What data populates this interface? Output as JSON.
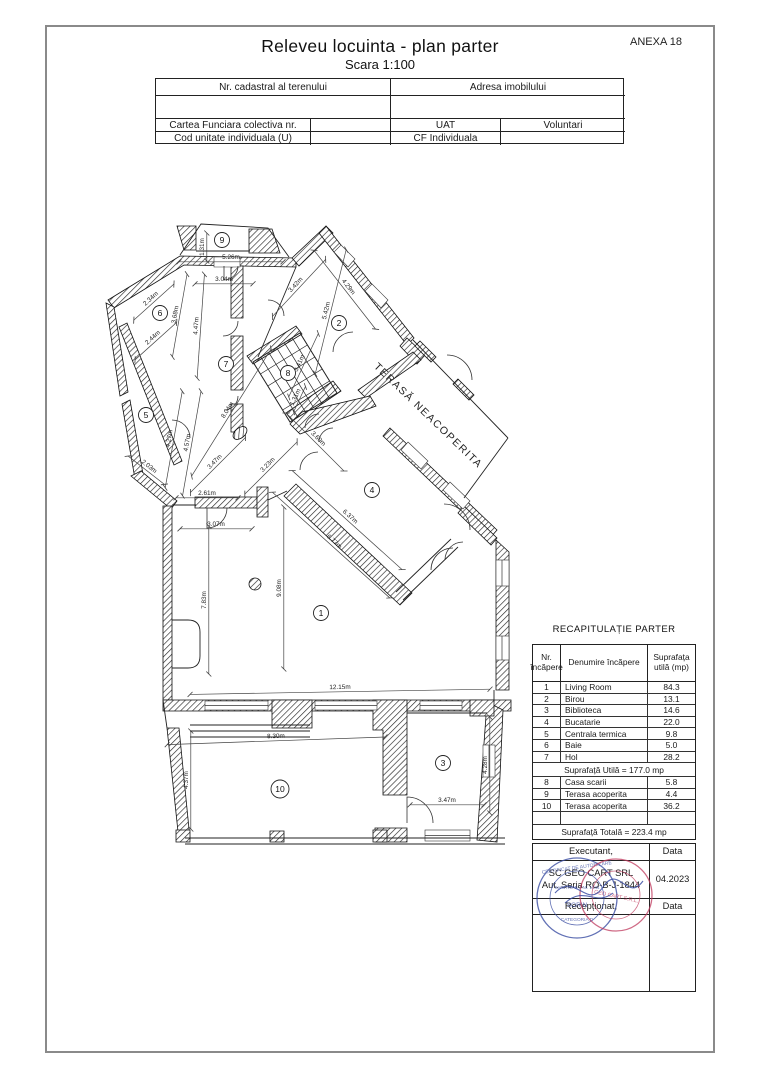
{
  "page": {
    "anexa": "ANEXA 18",
    "title": "Releveu locuinta - plan parter",
    "subtitle": "Scara 1:100"
  },
  "header_table": {
    "nr_cadastral": "Nr. cadastral al terenului",
    "adresa": "Adresa imobilului",
    "cartea": "Cartea Funciara colectiva nr.",
    "cartea_val": "",
    "uat": "UAT",
    "uat_val": "Voluntari",
    "cod": "Cod unitate individuala (U)",
    "cod_val": "",
    "cf": "CF Individuala",
    "cf_val": ""
  },
  "plan": {
    "terasa_label": {
      "t": "TERASĂ NEACOPERITA",
      "x": 426,
      "y": 418,
      "r": 44
    },
    "rooms": [
      {
        "n": "1",
        "x": 321,
        "y": 613
      },
      {
        "n": "2",
        "x": 339,
        "y": 323
      },
      {
        "n": "3",
        "x": 443,
        "y": 763
      },
      {
        "n": "4",
        "x": 372,
        "y": 490
      },
      {
        "n": "5",
        "x": 146,
        "y": 415
      },
      {
        "n": "6",
        "x": 160,
        "y": 313
      },
      {
        "n": "7",
        "x": 226,
        "y": 364
      },
      {
        "n": "8",
        "x": 288,
        "y": 373
      },
      {
        "n": "9",
        "x": 222,
        "y": 240
      },
      {
        "n": "10",
        "x": 280,
        "y": 789
      }
    ],
    "dims": [
      {
        "t": "1.31m",
        "x": 204,
        "y": 247,
        "r": -90,
        "len": 28
      },
      {
        "t": "5.26m",
        "x": 231,
        "y": 259,
        "r": 0,
        "len": 104
      },
      {
        "t": "3.04m",
        "x": 224,
        "y": 281,
        "r": 0,
        "len": 58
      },
      {
        "t": "3.42m",
        "x": 297,
        "y": 286,
        "r": -47,
        "len": 78
      },
      {
        "t": "4.29m",
        "x": 347,
        "y": 288,
        "r": 52,
        "len": 100
      },
      {
        "t": "5.42m",
        "x": 328,
        "y": 311,
        "r": -76,
        "len": 128
      },
      {
        "t": "2.34m",
        "x": 152,
        "y": 300,
        "r": -42,
        "len": 54
      },
      {
        "t": "3.68m",
        "x": 177,
        "y": 315,
        "r": -80,
        "len": 84
      },
      {
        "t": "2.44m",
        "x": 154,
        "y": 339,
        "r": -42,
        "len": 56
      },
      {
        "t": "4.47m",
        "x": 198,
        "y": 326,
        "r": -86,
        "len": 104
      },
      {
        "t": "8.04m",
        "x": 229,
        "y": 411,
        "r": -58,
        "len": 150
      },
      {
        "t": "3.41m",
        "x": 301,
        "y": 364,
        "r": -65,
        "len": 70
      },
      {
        "t": "1.31m",
        "x": 297,
        "y": 398,
        "r": -65,
        "len": 28
      },
      {
        "t": "3.60m",
        "x": 317,
        "y": 440,
        "r": 45,
        "len": 82
      },
      {
        "t": "3.23m",
        "x": 269,
        "y": 466,
        "r": -45,
        "len": 74
      },
      {
        "t": "4.27m",
        "x": 171,
        "y": 439,
        "r": -80,
        "len": 98
      },
      {
        "t": "4.57m",
        "x": 189,
        "y": 443,
        "r": -80,
        "len": 106
      },
      {
        "t": "2.03m",
        "x": 148,
        "y": 468,
        "r": 38,
        "len": 46
      },
      {
        "t": "3.47m",
        "x": 216,
        "y": 463,
        "r": -45,
        "len": 78
      },
      {
        "t": "2.61m",
        "x": 207,
        "y": 495,
        "r": 0,
        "len": 62
      },
      {
        "t": "3.07m",
        "x": 216,
        "y": 526,
        "r": 0,
        "len": 72
      },
      {
        "t": "6.37m",
        "x": 349,
        "y": 518,
        "r": 42,
        "len": 148
      },
      {
        "t": "6.77m",
        "x": 333,
        "y": 543,
        "r": 42,
        "len": 158
      },
      {
        "t": "7.83m",
        "x": 206,
        "y": 600,
        "r": -90,
        "len": 148
      },
      {
        "t": "9.08m",
        "x": 281,
        "y": 588,
        "r": -90,
        "len": 162
      },
      {
        "t": "12.15m",
        "x": 340,
        "y": 689,
        "r": -1,
        "len": 300
      },
      {
        "t": "8.30m",
        "x": 276,
        "y": 738,
        "r": -2,
        "len": 218
      },
      {
        "t": "4.37m",
        "x": 188,
        "y": 780,
        "r": -90,
        "len": 98
      },
      {
        "t": "3.47m",
        "x": 447,
        "y": 802,
        "r": 0,
        "len": 74
      },
      {
        "t": "4.28m",
        "x": 487,
        "y": 765,
        "r": -90,
        "len": 96
      }
    ]
  },
  "recap": {
    "title": "RECAPITULAȚIE PARTER",
    "headers": [
      "Nr. încăpere",
      "Denumire încăpere",
      "Suprafața utilă (mp)"
    ],
    "rows": [
      {
        "nr": "1",
        "name": "Living Room",
        "area": "84.3"
      },
      {
        "nr": "2",
        "name": "Birou",
        "area": "13.1"
      },
      {
        "nr": "3",
        "name": "Biblioteca",
        "area": "14.6"
      },
      {
        "nr": "4",
        "name": "Bucatarie",
        "area": "22.0"
      },
      {
        "nr": "5",
        "name": "Centrala termica",
        "area": "9.8"
      },
      {
        "nr": "6",
        "name": "Baie",
        "area": "5.0"
      },
      {
        "nr": "7",
        "name": "Hol",
        "area": "28.2"
      }
    ],
    "subtotal": "Suprafață Utilă = 177.0 mp",
    "rows2": [
      {
        "nr": "8",
        "name": "Casa scarii",
        "area": "5.8"
      },
      {
        "nr": "9",
        "name": "Terasa acoperita",
        "area": "4.4"
      },
      {
        "nr": "10",
        "name": "Terasa acoperita",
        "area": "36.2"
      }
    ],
    "total": "Suprafață Totală = 223.4 mp"
  },
  "signoff": {
    "executant_label": "Executant,",
    "data_label": "Data",
    "executant_name": "SC GEO CART SRL",
    "executant_auth": "Aut. Seria RO-B-J-1844",
    "date": "04.2023",
    "receptionat_label": "Recepționat,",
    "data_label2": "Data",
    "stamps": {
      "blue_color": "#3b4ea3",
      "red_color": "#c03a5e",
      "blue_top": "CERTIFICAT DE AUTORIZARE",
      "blue_mid": "Seria RO-B-J Nr. 1844",
      "blue_name": "SORIN",
      "blue_cat": "CATEGORIA D",
      "red_name": "GEO CART S.R.L."
    }
  }
}
